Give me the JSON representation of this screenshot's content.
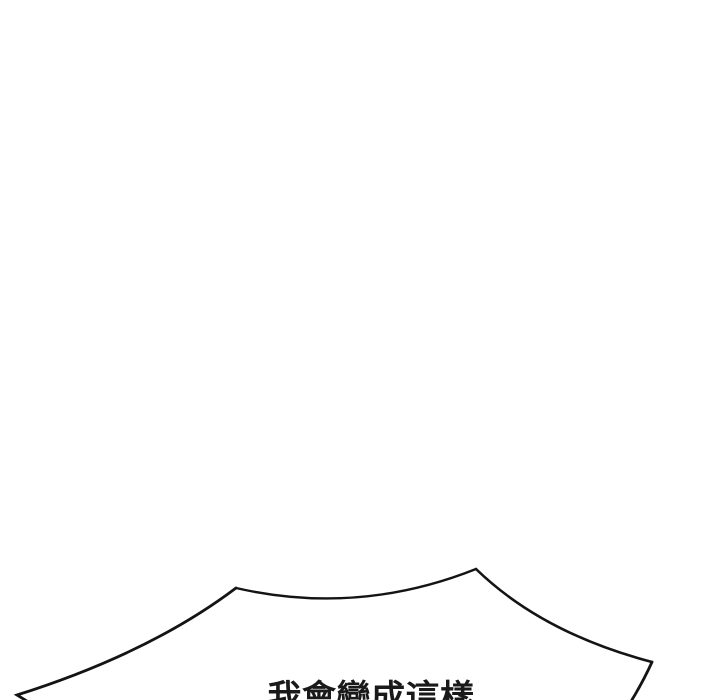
{
  "panel": {
    "background_color": "#ffffff",
    "outline_color": "#141414",
    "text_color": "#1a1a1a",
    "speech_bubble": {
      "text": "我會變成這樣"
    }
  }
}
